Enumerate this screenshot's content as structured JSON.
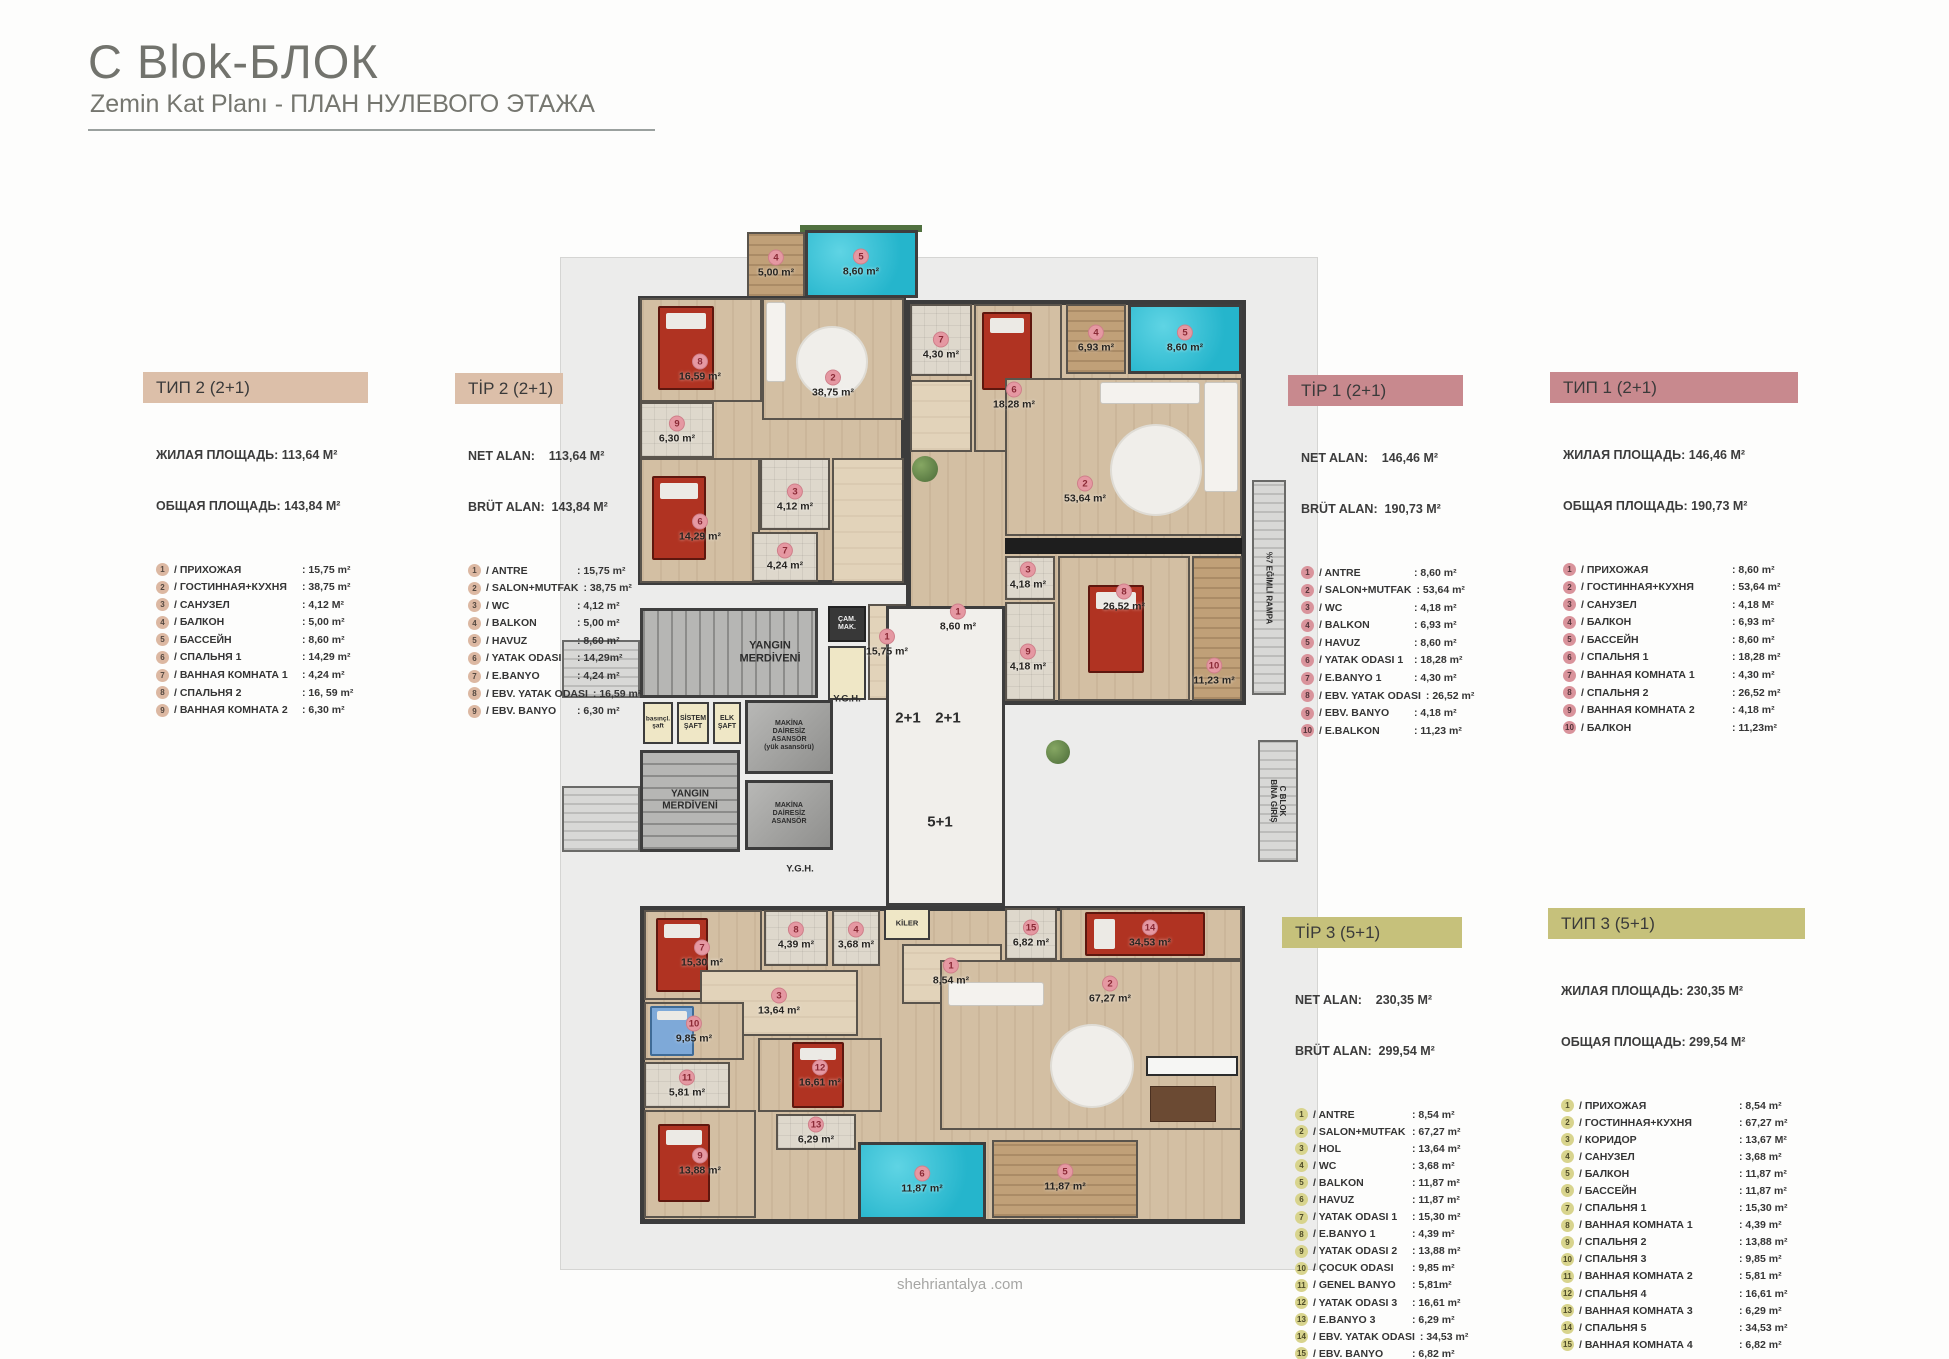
{
  "page": {
    "title": "C Blok-БЛОК",
    "subtitle": "Zemin Kat Planı - ПЛАН НУЛЕВОГО ЭТАЖА",
    "footer": "shehriantalya .com"
  },
  "colors": {
    "header_tan": "#dcbfa9",
    "header_pink": "#c8898e",
    "header_olive": "#c6c17b",
    "pool": "#2ec2d9",
    "panel_gray": "#ececeb"
  },
  "legends": {
    "ru_tip2": {
      "title": "ТИП 2 (2+1)",
      "lines": [
        "ЖИЛАЯ ПЛОЩАДЬ: 113,64 М²",
        "ОБЩАЯ ПЛОЩАДЬ: 143,84 М²"
      ],
      "rows": [
        {
          "n": "1",
          "label": "ПРИХОЖАЯ",
          "value": "15,75 m²"
        },
        {
          "n": "2",
          "label": "ГОСТИННАЯ+КУХНЯ",
          "value": "38,75 m²"
        },
        {
          "n": "3",
          "label": "САНУЗЕЛ",
          "value": "4,12 М²"
        },
        {
          "n": "4",
          "label": "БАЛКОН",
          "value": "5,00 m²"
        },
        {
          "n": "5",
          "label": "БАССЕЙН",
          "value": "8,60 m²"
        },
        {
          "n": "6",
          "label": "СПАЛЬНЯ 1",
          "value": "14,29 m²"
        },
        {
          "n": "7",
          "label": "ВАННАЯ КОМНАТА 1",
          "value": "4,24 m²"
        },
        {
          "n": "8",
          "label": "СПАЛЬНЯ 2",
          "value": "16, 59 m²"
        },
        {
          "n": "9",
          "label": "ВАННАЯ КОМНАТА 2",
          "value": "6,30 m²"
        }
      ]
    },
    "tr_tip2": {
      "title": "TİP 2 (2+1)",
      "lines": [
        "NET ALAN:    113,64 M²",
        "BRÜT ALAN:  143,84 M²"
      ],
      "rows": [
        {
          "n": "1",
          "label": "ANTRE",
          "value": "15,75 m²"
        },
        {
          "n": "2",
          "label": "SALON+MUTFAK",
          "value": "38,75 m²"
        },
        {
          "n": "3",
          "label": "WC",
          "value": "4,12 m²"
        },
        {
          "n": "4",
          "label": "BALKON",
          "value": "5,00 m²"
        },
        {
          "n": "5",
          "label": "HAVUZ",
          "value": "8,60 m²"
        },
        {
          "n": "6",
          "label": "YATAK ODASI",
          "value": "14,29m²"
        },
        {
          "n": "7",
          "label": "E.BANYO",
          "value": "4,24 m²"
        },
        {
          "n": "8",
          "label": "EBV. YATAK ODASI",
          "value": "16,59 m²"
        },
        {
          "n": "9",
          "label": "EBV. BANYO",
          "value": "6,30 m²"
        }
      ]
    },
    "tr_tip1": {
      "title": "TİP 1 (2+1)",
      "lines": [
        "NET ALAN:    146,46 M²",
        "BRÜT ALAN:  190,73 M²"
      ],
      "rows": [
        {
          "n": "1",
          "label": "ANTRE",
          "value": "8,60 m²"
        },
        {
          "n": "2",
          "label": "SALON+MUTFAK",
          "value": "53,64 m²"
        },
        {
          "n": "3",
          "label": "WC",
          "value": "4,18 m²"
        },
        {
          "n": "4",
          "label": "BALKON",
          "value": "6,93 m²"
        },
        {
          "n": "5",
          "label": "HAVUZ",
          "value": "8,60 m²"
        },
        {
          "n": "6",
          "label": "YATAK ODASI 1",
          "value": "18,28 m²"
        },
        {
          "n": "7",
          "label": "E.BANYO 1",
          "value": "4,30 m²"
        },
        {
          "n": "8",
          "label": "EBV. YATAK ODASI",
          "value": "26,52 m²"
        },
        {
          "n": "9",
          "label": "EBV. BANYO",
          "value": "4,18 m²"
        },
        {
          "n": "10",
          "label": "E.BALKON",
          "value": "11,23 m²"
        }
      ]
    },
    "ru_tip1": {
      "title": "ТИП 1 (2+1)",
      "lines": [
        "ЖИЛАЯ ПЛОЩАДЬ: 146,46 М²",
        "ОБЩАЯ ПЛОЩАДЬ: 190,73 М²"
      ],
      "rows": [
        {
          "n": "1",
          "label": "ПРИХОЖАЯ",
          "value": "8,60 m²"
        },
        {
          "n": "2",
          "label": "ГОСТИННАЯ+КУХНЯ",
          "value": "53,64 m²"
        },
        {
          "n": "3",
          "label": "САНУЗЕЛ",
          "value": "4,18 М²"
        },
        {
          "n": "4",
          "label": "БАЛКОН",
          "value": "6,93 m²"
        },
        {
          "n": "5",
          "label": "БАССЕЙН",
          "value": "8,60 m²"
        },
        {
          "n": "6",
          "label": "СПАЛЬНЯ 1",
          "value": "18,28 m²"
        },
        {
          "n": "7",
          "label": "ВАННАЯ КОМНАТА 1",
          "value": "4,30 m²"
        },
        {
          "n": "8",
          "label": "СПАЛЬНЯ 2",
          "value": "26,52 m²"
        },
        {
          "n": "9",
          "label": "ВАННАЯ КОМНАТА 2",
          "value": "4,18 m²"
        },
        {
          "n": "10",
          "label": "БАЛКОН",
          "value": "11,23m²"
        }
      ]
    },
    "tr_tip3": {
      "title": "TİP 3 (5+1)",
      "lines": [
        "NET ALAN:    230,35 M²",
        "BRÜT ALAN:  299,54 M²"
      ],
      "rows": [
        {
          "n": "1",
          "label": "ANTRE",
          "value": "8,54 m²"
        },
        {
          "n": "2",
          "label": "SALON+MUTFAK",
          "value": "67,27 m²"
        },
        {
          "n": "3",
          "label": "HOL",
          "value": "13,64 m²"
        },
        {
          "n": "4",
          "label": "WC",
          "value": "3,68 m²"
        },
        {
          "n": "5",
          "label": "BALKON",
          "value": "11,87 m²"
        },
        {
          "n": "6",
          "label": "HAVUZ",
          "value": "11,87 m²"
        },
        {
          "n": "7",
          "label": "YATAK ODASI 1",
          "value": "15,30 m²"
        },
        {
          "n": "8",
          "label": "E.BANYO 1",
          "value": "4,39 m²"
        },
        {
          "n": "9",
          "label": "YATAK ODASI 2",
          "value": "13,88 m²"
        },
        {
          "n": "10",
          "label": "ÇOCUK ODASI",
          "value": "9,85 m²"
        },
        {
          "n": "11",
          "label": "GENEL BANYO",
          "value": "5,81m²"
        },
        {
          "n": "12",
          "label": "YATAK ODASI 3",
          "value": "16,61 m²"
        },
        {
          "n": "13",
          "label": "E.BANYO 3",
          "value": "6,29 m²"
        },
        {
          "n": "14",
          "label": "EBV. YATAK ODASI",
          "value": "34,53 m²"
        },
        {
          "n": "15",
          "label": "EBV. BANYO",
          "value": "6,82 m²"
        }
      ]
    },
    "ru_tip3": {
      "title": "ТИП 3 (5+1)",
      "lines": [
        "ЖИЛАЯ ПЛОЩАДЬ: 230,35 М²",
        "ОБЩАЯ ПЛОЩАДЬ: 299,54 М²"
      ],
      "rows": [
        {
          "n": "1",
          "label": "ПРИХОЖАЯ",
          "value": "8,54 m²"
        },
        {
          "n": "2",
          "label": "ГОСТИННАЯ+КУХНЯ",
          "value": "67,27 m²"
        },
        {
          "n": "3",
          "label": "КОРИДОР",
          "value": "13,67 М²"
        },
        {
          "n": "4",
          "label": "САНУЗЕЛ",
          "value": "3,68 m²"
        },
        {
          "n": "5",
          "label": "БАЛКОН",
          "value": "11,87 m²"
        },
        {
          "n": "6",
          "label": "БАССЕЙН",
          "value": "11,87 m²"
        },
        {
          "n": "7",
          "label": "СПАЛЬНЯ 1",
          "value": "15,30 m²"
        },
        {
          "n": "8",
          "label": "ВАННАЯ КОМНАТА 1",
          "value": "4,39 m²"
        },
        {
          "n": "9",
          "label": "СПАЛЬНЯ 2",
          "value": "13,88 m²"
        },
        {
          "n": "10",
          "label": "СПАЛЬНЯ 3",
          "value": "9,85 m²"
        },
        {
          "n": "11",
          "label": "ВАННАЯ КОМНАТА 2",
          "value": "5,81 m²"
        },
        {
          "n": "12",
          "label": "СПАЛЬНЯ 4",
          "value": "16,61 m²"
        },
        {
          "n": "13",
          "label": "ВАННАЯ КОМНАТА 3",
          "value": "6,29 m²"
        },
        {
          "n": "14",
          "label": "СПАЛЬНЯ 5",
          "value": "34,53 m²"
        },
        {
          "n": "15",
          "label": "ВАННАЯ КОМНАТА 4",
          "value": "6,82 m²"
        }
      ]
    }
  },
  "plan": {
    "room_labels": [
      {
        "n": "4",
        "a": "5,00 m²",
        "x": 776,
        "y": 264
      },
      {
        "n": "5",
        "a": "8,60 m²",
        "x": 861,
        "y": 263
      },
      {
        "n": "8",
        "a": "16,59 m²",
        "x": 700,
        "y": 368
      },
      {
        "n": "2",
        "a": "38,75 m²",
        "x": 833,
        "y": 384
      },
      {
        "n": "9",
        "a": "6,30 m²",
        "x": 677,
        "y": 430
      },
      {
        "n": "7",
        "a": "4,30 m²",
        "x": 941,
        "y": 346
      },
      {
        "n": "6",
        "a": "18,28 m²",
        "x": 1014,
        "y": 396
      },
      {
        "n": "4",
        "a": "6,93 m²",
        "x": 1096,
        "y": 339
      },
      {
        "n": "5",
        "a": "8,60 m²",
        "x": 1185,
        "y": 339
      },
      {
        "n": "6",
        "a": "14,29 m²",
        "x": 700,
        "y": 528
      },
      {
        "n": "3",
        "a": "4,12 m²",
        "x": 795,
        "y": 498
      },
      {
        "n": "2",
        "a": "53,64 m²",
        "x": 1085,
        "y": 490
      },
      {
        "n": "7",
        "a": "4,24 m²",
        "x": 785,
        "y": 557
      },
      {
        "n": "3",
        "a": "4,18 m²",
        "x": 1028,
        "y": 576
      },
      {
        "n": "1",
        "a": "15,75 m²",
        "x": 887,
        "y": 643
      },
      {
        "n": "1",
        "a": "8,60 m²",
        "x": 958,
        "y": 618
      },
      {
        "n": "8",
        "a": "26,52 m²",
        "x": 1124,
        "y": 598
      },
      {
        "n": "9",
        "a": "4,18 m²",
        "x": 1028,
        "y": 658
      },
      {
        "n": "10",
        "a": "11,23 m²",
        "x": 1214,
        "y": 672
      },
      {
        "n": "15",
        "a": "6,82 m²",
        "x": 1031,
        "y": 934
      },
      {
        "n": "14",
        "a": "34,53 m²",
        "x": 1150,
        "y": 934
      },
      {
        "n": "8",
        "a": "4,39 m²",
        "x": 796,
        "y": 936
      },
      {
        "n": "4",
        "a": "3,68 m²",
        "x": 856,
        "y": 936
      },
      {
        "n": "1",
        "a": "8,54 m²",
        "x": 951,
        "y": 972
      },
      {
        "n": "7",
        "a": "15,30 m²",
        "x": 702,
        "y": 954
      },
      {
        "n": "3",
        "a": "13,64 m²",
        "x": 779,
        "y": 1002
      },
      {
        "n": "2",
        "a": "67,27 m²",
        "x": 1110,
        "y": 990
      },
      {
        "n": "10",
        "a": "9,85 m²",
        "x": 694,
        "y": 1030
      },
      {
        "n": "11",
        "a": "5,81 m²",
        "x": 687,
        "y": 1084
      },
      {
        "n": "12",
        "a": "16,61 m²",
        "x": 820,
        "y": 1074
      },
      {
        "n": "13",
        "a": "6,29 m²",
        "x": 816,
        "y": 1131
      },
      {
        "n": "9",
        "a": "13,88 m²",
        "x": 700,
        "y": 1162
      },
      {
        "n": "6",
        "a": "11,87 m²",
        "x": 922,
        "y": 1180
      },
      {
        "n": "5",
        "a": "11,87 m²",
        "x": 1065,
        "y": 1178
      }
    ],
    "core_labels": [
      {
        "t": "YANGIN\nMERDİVENİ",
        "x": 770,
        "y": 652,
        "s": 11
      },
      {
        "t": "YANGIN\nMERDİVENİ",
        "x": 690,
        "y": 800,
        "s": 10
      },
      {
        "t": "basınçl.\nşaft",
        "x": 658,
        "y": 723,
        "s": 6.5
      },
      {
        "t": "SİSTEM\nŞAFT",
        "x": 693,
        "y": 723,
        "s": 7
      },
      {
        "t": "ELK\nŞAFT",
        "x": 727,
        "y": 723,
        "s": 7
      },
      {
        "t": "MAKİNA\nDAİRESİZ\nASANSÖR\n(yük asansörü)",
        "x": 789,
        "y": 736,
        "s": 7
      },
      {
        "t": "MAKİNA\nDAİRESİZ\nASANSÖR",
        "x": 789,
        "y": 814,
        "s": 7
      },
      {
        "t": "ÇAM.\nMAK.",
        "x": 847,
        "y": 624,
        "s": 7,
        "light": true
      },
      {
        "t": "Y.G.H.",
        "x": 847,
        "y": 700,
        "s": 9.5
      },
      {
        "t": "Y.G.H.",
        "x": 800,
        "y": 870,
        "s": 9.5
      },
      {
        "t": "2+1",
        "x": 908,
        "y": 718,
        "s": 15
      },
      {
        "t": "2+1",
        "x": 948,
        "y": 718,
        "s": 15
      },
      {
        "t": "5+1",
        "x": 940,
        "y": 822,
        "s": 15
      },
      {
        "t": "KİLER",
        "x": 907,
        "y": 924,
        "s": 7.5
      },
      {
        "t": "%7 EĞİMLİ RAMPA",
        "x": 1269,
        "y": 588,
        "s": 8,
        "rot": true
      },
      {
        "t": "C BLOK\nBİNA GİRİŞ",
        "x": 1278,
        "y": 801,
        "s": 8,
        "rot": true
      }
    ]
  }
}
